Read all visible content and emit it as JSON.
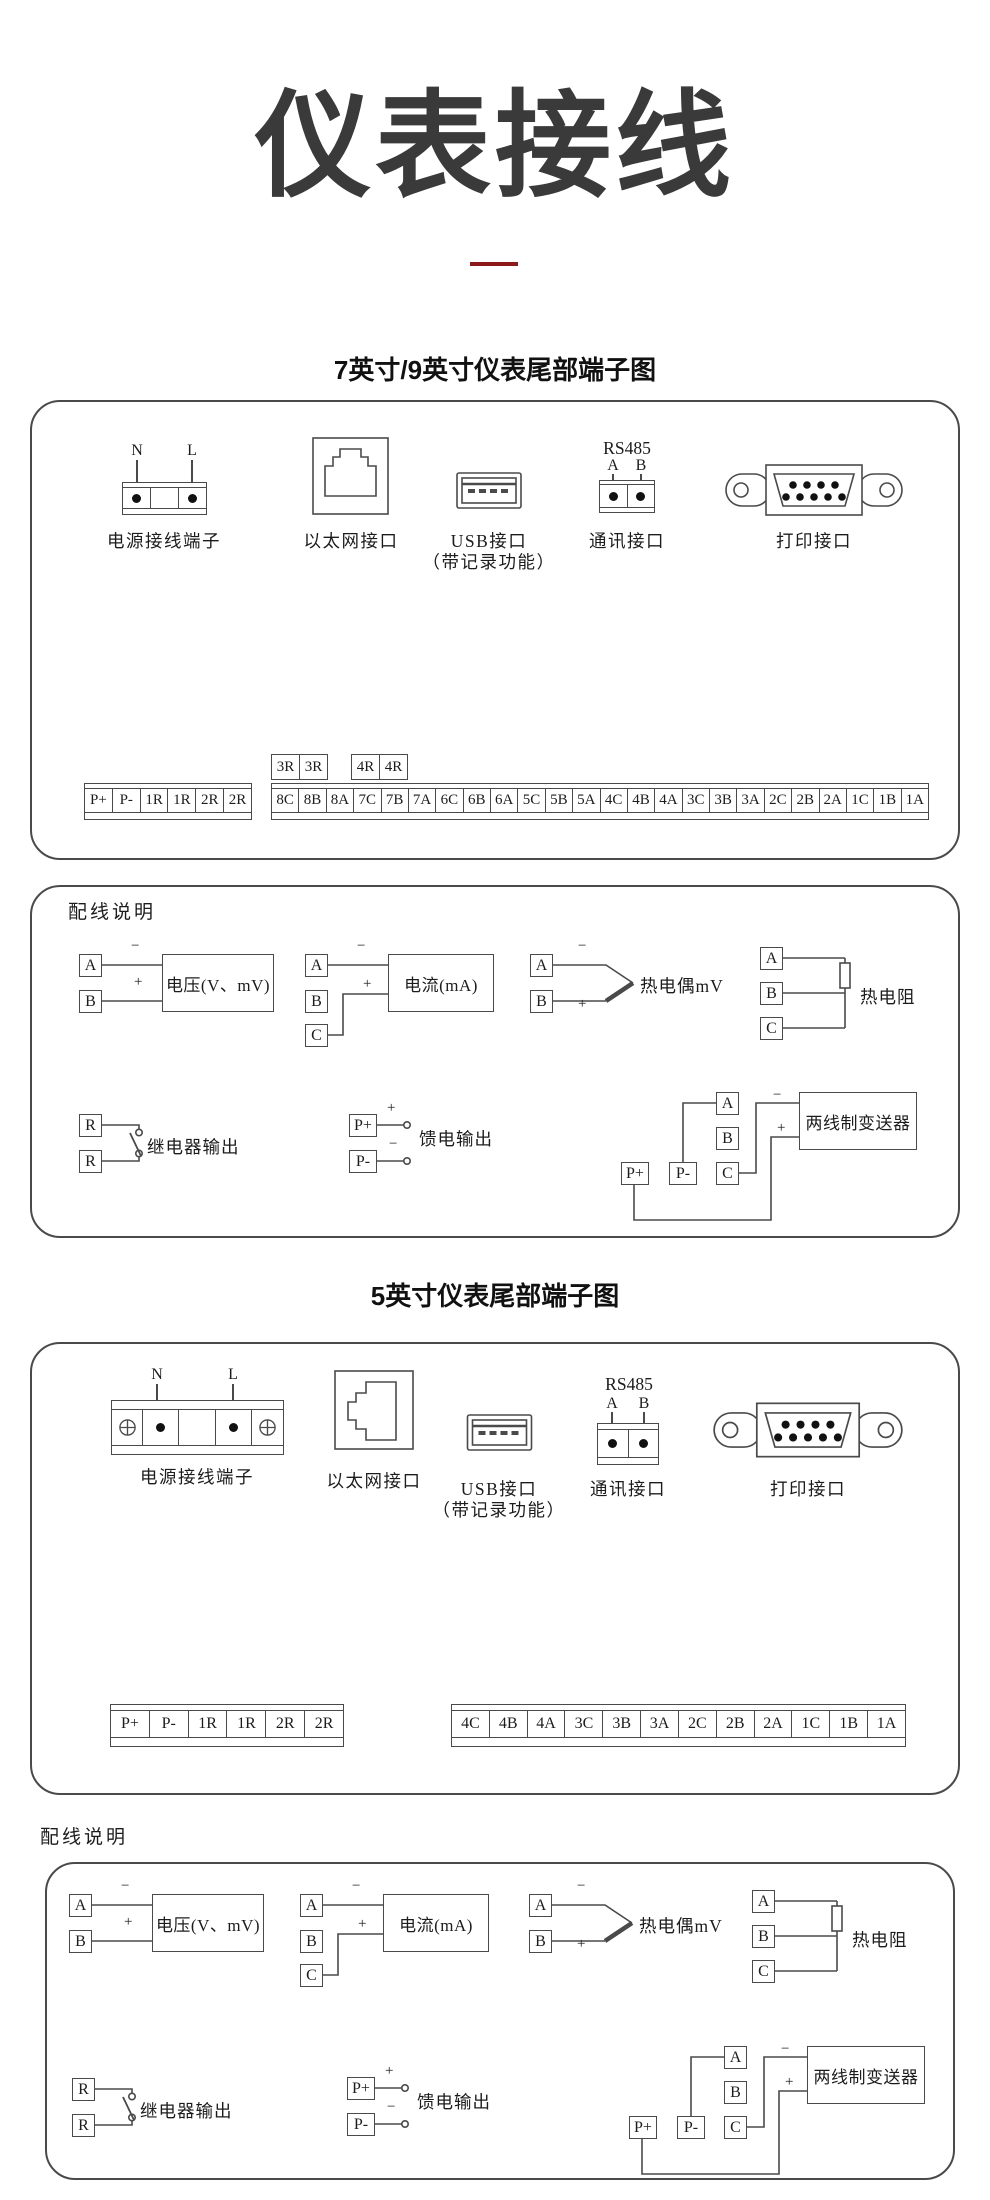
{
  "page": {
    "title": "仪表接线",
    "accent_color": "#8b1a1a",
    "line_color": "#4a4a4a"
  },
  "sections": {
    "seven_nine_title": "7英寸/9英寸仪表尾部端子图",
    "five_title": "5英寸仪表尾部端子图",
    "wiring_note_title": "配线说明"
  },
  "connectors": {
    "power_label": "电源接线端子",
    "power_pin_n": "N",
    "power_pin_l": "L",
    "ethernet_label": "以太网接口",
    "usb_label": "USB接口",
    "usb_sublabel": "（带记录功能）",
    "rs485_title": "RS485",
    "rs485_pin_a": "A",
    "rs485_pin_b": "B",
    "comm_label": "通讯接口",
    "print_label": "打印接口"
  },
  "terminals_7_9": {
    "left": [
      "P+",
      "P-",
      "1R",
      "1R",
      "2R",
      "2R"
    ],
    "top_left": [
      "3R",
      "3R"
    ],
    "top_right": [
      "4R",
      "4R"
    ],
    "main": [
      "8C",
      "8B",
      "8A",
      "7C",
      "7B",
      "7A",
      "6C",
      "6B",
      "6A",
      "5C",
      "5B",
      "5A",
      "4C",
      "4B",
      "4A",
      "3C",
      "3B",
      "3A",
      "2C",
      "2B",
      "2A",
      "1C",
      "1B",
      "1A"
    ]
  },
  "terminals_5": {
    "left": [
      "P+",
      "P-",
      "1R",
      "1R",
      "2R",
      "2R"
    ],
    "main": [
      "4C",
      "4B",
      "4A",
      "3C",
      "3B",
      "3A",
      "2C",
      "2B",
      "2A",
      "1C",
      "1B",
      "1A"
    ]
  },
  "wiring": {
    "t_a": "A",
    "t_b": "B",
    "t_c": "C",
    "t_r": "R",
    "t_pp": "P+",
    "t_pm": "P-",
    "plus": "+",
    "minus": "−",
    "voltage_box": "电压(V、mV)",
    "current_box": "电流(mA)",
    "thermocouple_label": "热电偶mV",
    "rtd_label": "热电阻",
    "relay_label": "继电器输出",
    "feed_label": "馈电输出",
    "transmitter_box": "两线制变送器"
  }
}
